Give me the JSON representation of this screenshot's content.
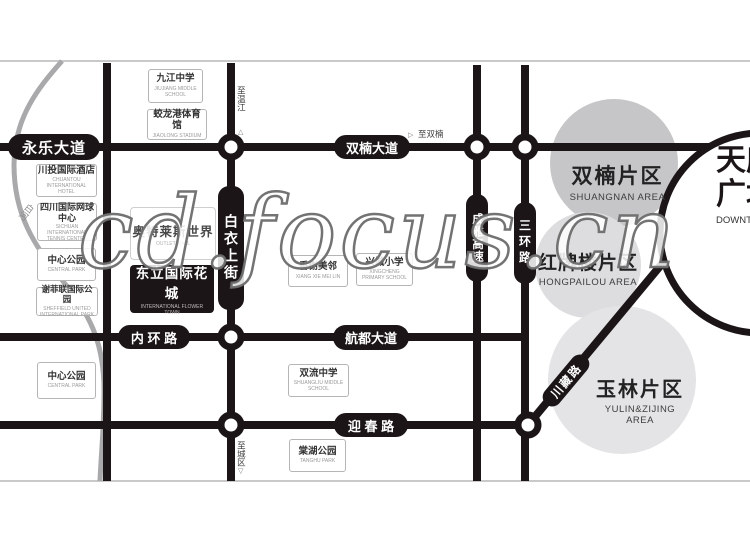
{
  "watermark": "cd.focus.cn",
  "roads": {
    "yongle": "永乐大道",
    "shuangnan_ave": "双楠大道",
    "neihuan": "内 环 路",
    "hangdu": "航都大道",
    "yingchun": "迎 春 路",
    "baiyi_upper_street": "白衣上街",
    "chengya_expressway": "成雅高速",
    "third_ring": "三环路",
    "chuanzang": "川藏路"
  },
  "directions": {
    "to_wenjiang": "至温江",
    "to_shuangnan": "至双楠",
    "to_city": "至城区",
    "up_triangle": "△",
    "right_triangle": "▷",
    "down_triangle": "▽"
  },
  "river": {
    "label": "白河"
  },
  "project": {
    "name": "东立国际花城",
    "en": "INTERNATIONAL FLOWER TOWN"
  },
  "mall": {
    "name": "奥特莱斯世界",
    "en": "OUTLET MALL"
  },
  "pois": [
    {
      "name": "九江中学",
      "en": "JIUJIANG MIDDLE SCHOOL"
    },
    {
      "name": "蛟龙港体育馆",
      "en": "JIAOLONG STADIUM"
    },
    {
      "name": "川投国际酒店",
      "en": "CHUANTOU INTERNATIONAL HOTEL"
    },
    {
      "name": "四川国际网球中心",
      "en": "SICHUAN INTERNATIONAL TENNIS CENTER"
    },
    {
      "name": "中心公园",
      "en": "CENTRAL PARK"
    },
    {
      "name": "谢菲联国际公园",
      "en": "SHEFFIELD UNITED INTERNATIONAL PARK"
    },
    {
      "name": "中心公园",
      "en": "CENTRAL PARK"
    },
    {
      "name": "香榭美邻",
      "en": "XIANG XIE MEI LIN"
    },
    {
      "name": "兴城小学",
      "en": "XINGCHENG PRIMARY SCHOOL"
    },
    {
      "name": "双流中学",
      "en": "SHUANGLIU MIDDLE SCHOOL"
    },
    {
      "name": "棠湖公园",
      "en": "TANGHU PARK"
    }
  ],
  "areas": [
    {
      "name": "双楠片区",
      "en": "SHUANGNAN AREA"
    },
    {
      "name": "红牌楼片区",
      "en": "HONGPAILOU AREA"
    },
    {
      "name": "玉林片区",
      "en": "YULIN&ZIJING AREA"
    }
  ],
  "downtown": {
    "line1": "天府",
    "line2": "广场",
    "en": "DOWNTOWN AREA"
  },
  "colors": {
    "road": "#1c1517",
    "river": "#a9a9ab",
    "area_dark": "#c6c6c8",
    "area_mid": "#dddde0",
    "area_light": "#e4e4e6"
  }
}
